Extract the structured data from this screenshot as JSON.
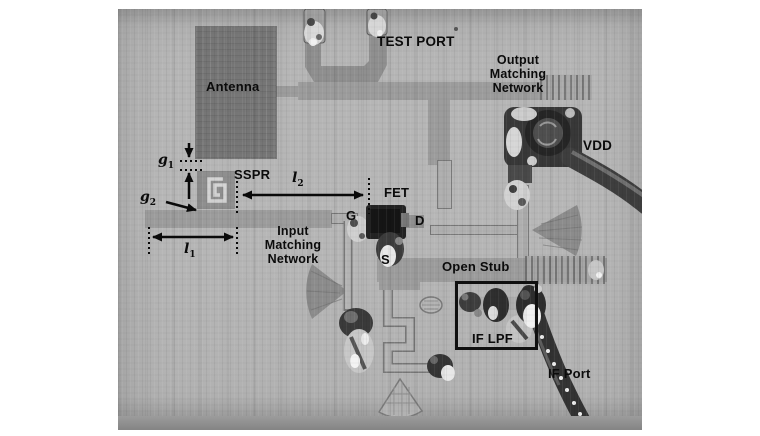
{
  "labels": {
    "antenna": "Antenna",
    "test_port": "TEST PORT",
    "output_matching": [
      "Output",
      "Matching",
      "Network"
    ],
    "vdd": "VDD",
    "sspr": "SSPR",
    "fet": "FET",
    "gate": "G",
    "drain": "D",
    "source": "S",
    "input_matching": [
      "Input",
      "Matching",
      "Network"
    ],
    "open_stub": "Open Stub",
    "if_lpf": "IF LPF",
    "if_port": "IF Port"
  },
  "dims": {
    "g1": {
      "base": "g",
      "sub": "1"
    },
    "g2": {
      "base": "g",
      "sub": "2"
    },
    "l1": {
      "base": "l",
      "sub": "1"
    },
    "l2": {
      "base": "l",
      "sub": "2"
    }
  },
  "colors": {
    "page_bg": "#ffffff",
    "photo_bg": "#b5b5b5",
    "copper_trace": "#9c9c9c",
    "antenna_patch": "#767676",
    "component_dark": "#2b2b2b",
    "solder_bright": "#e8e8e8",
    "annotation": "#0a0a0a"
  }
}
